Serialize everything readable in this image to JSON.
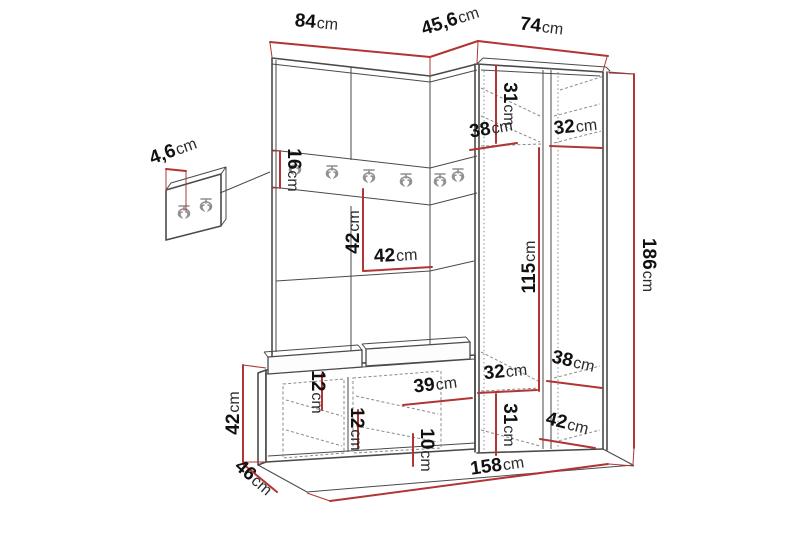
{
  "diagram": {
    "type": "furniture-dimension-diagram",
    "subject": "hallway-unit-with-wardrobe-hook-rail-and-bench",
    "colors": {
      "dimension": "#b23434",
      "outline": "#4a4a4a",
      "dashed": "#8a8a8a",
      "num": "#111111",
      "unit": "#2b2b2b",
      "background": "#ffffff"
    },
    "dims": {
      "top_left_width": {
        "value": "84",
        "unit": "cm"
      },
      "top_corner_width": {
        "value": "45,6",
        "unit": "cm"
      },
      "top_right_width": {
        "value": "74",
        "unit": "cm"
      },
      "hook_panel_depth": {
        "value": "4,6",
        "unit": "cm"
      },
      "hook_rail_height": {
        "value": "16",
        "unit": "cm"
      },
      "open_section_height": {
        "value": "42",
        "unit": "cm"
      },
      "open_shelf_width": {
        "value": "42",
        "unit": "cm"
      },
      "wardrobe_top_height": {
        "value": "31",
        "unit": "cm"
      },
      "wardrobe_top_depth": {
        "value": "38",
        "unit": "cm"
      },
      "wardrobe_top_width": {
        "value": "32",
        "unit": "cm"
      },
      "wardrobe_middle_height": {
        "value": "115",
        "unit": "cm"
      },
      "wardrobe_lower_width": {
        "value": "32",
        "unit": "cm"
      },
      "wardrobe_lower_depth": {
        "value": "38",
        "unit": "cm"
      },
      "wardrobe_lower_height": {
        "value": "31",
        "unit": "cm"
      },
      "wardrobe_base_depth": {
        "value": "42",
        "unit": "cm"
      },
      "total_height": {
        "value": "186",
        "unit": "cm"
      },
      "bench_top_height": {
        "value": "12",
        "unit": "cm"
      },
      "bench_shelf_height": {
        "value": "12",
        "unit": "cm"
      },
      "bench_compartment_width": {
        "value": "39",
        "unit": "cm"
      },
      "bench_lower_height": {
        "value": "10",
        "unit": "cm"
      },
      "bench_height": {
        "value": "42",
        "unit": "cm"
      },
      "bench_depth": {
        "value": "46",
        "unit": "cm"
      },
      "total_width": {
        "value": "158",
        "unit": "cm"
      }
    }
  }
}
